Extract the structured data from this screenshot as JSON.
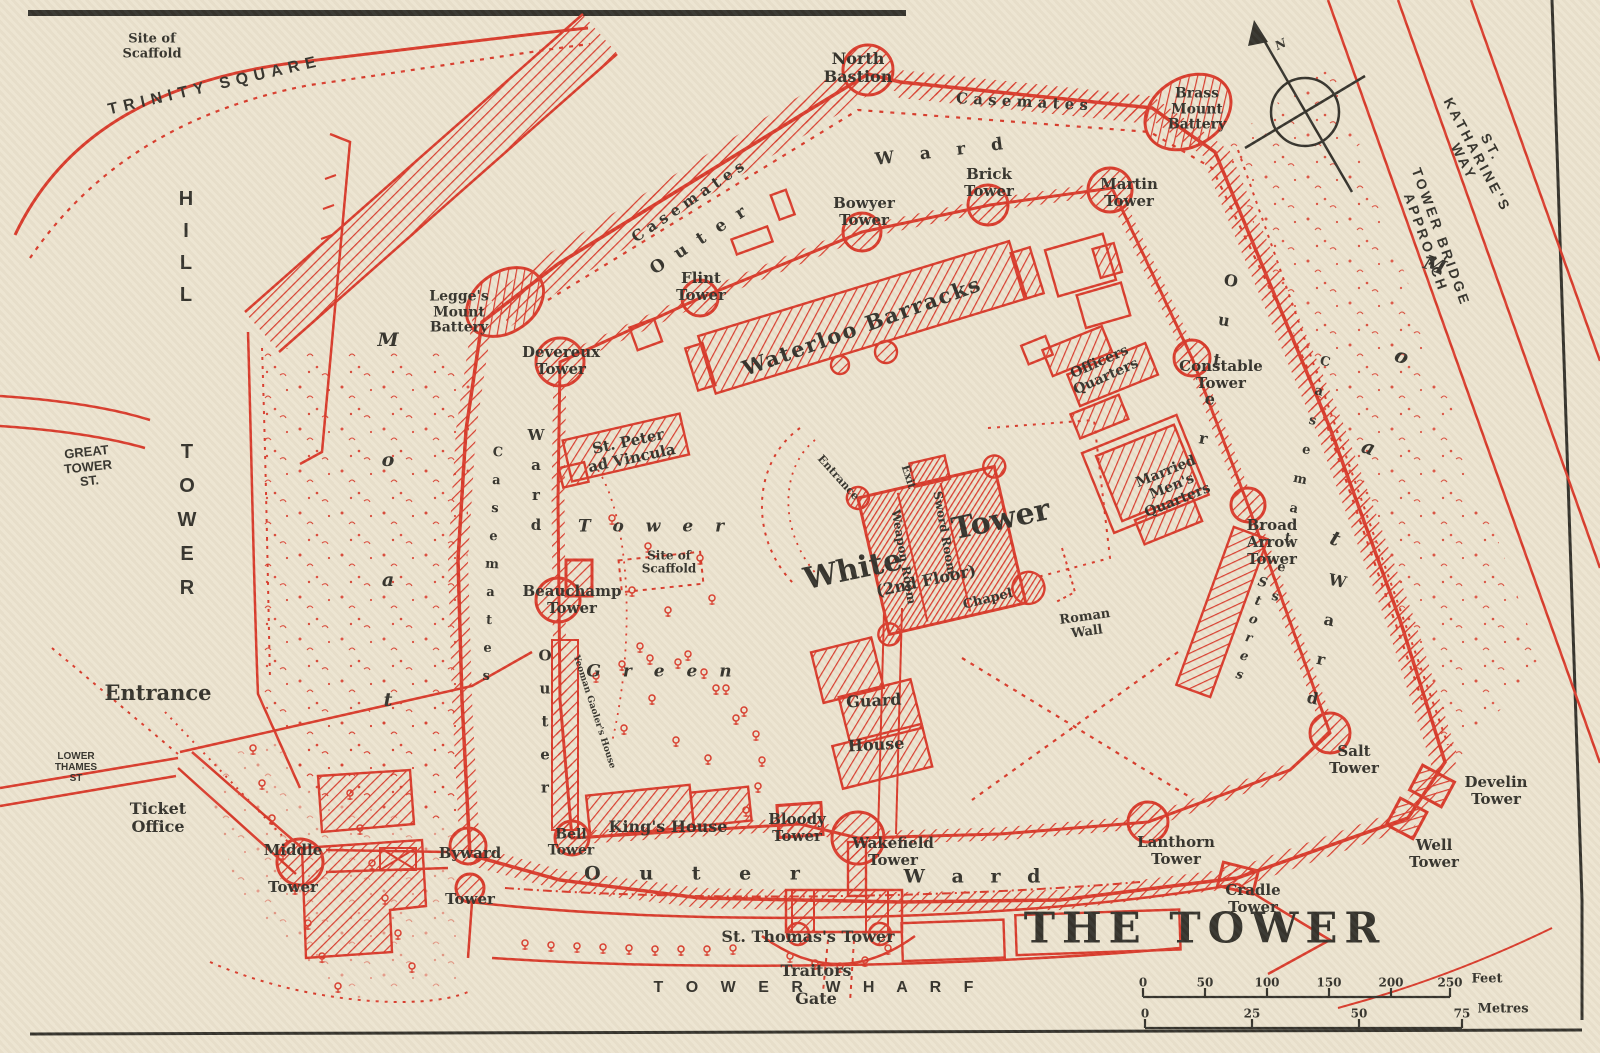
{
  "map": {
    "title": "THE TOWER",
    "subject": "Tower of London vintage plan",
    "colors": {
      "paper": "#ece4d0",
      "ink_red": "#d93a2b",
      "ink_black": "#33312b"
    },
    "compass": {
      "north_label": "N"
    }
  },
  "scale": {
    "feet": {
      "ticks": [
        "0",
        "50",
        "100",
        "150",
        "200",
        "250"
      ],
      "unit": "Feet"
    },
    "metres": {
      "ticks": [
        "0",
        "25",
        "50",
        "75"
      ],
      "unit": "Metres"
    }
  },
  "labels": [
    {
      "n": "site-of-scaffold-trinity",
      "t": "Site of\nScaffold",
      "x": 152,
      "y": 47,
      "s": 13
    },
    {
      "n": "trinity-square-street",
      "t": "TRINITY SQUARE",
      "x": 215,
      "y": 86,
      "s": 16,
      "r": -13,
      "c": "sans",
      "ls": 6
    },
    {
      "n": "tower-hill-street-word1",
      "t": "T\nO\nW\nE\nR",
      "x": 187,
      "y": 520,
      "s": 20,
      "c": "sans",
      "lh": 34
    },
    {
      "n": "tower-hill-street-word2",
      "t": "H\nI\nL\nL",
      "x": 186,
      "y": 247,
      "s": 20,
      "c": "sans",
      "lh": 32
    },
    {
      "n": "great-tower-st-street",
      "t": "GREAT\nTOWER\nST.",
      "x": 88,
      "y": 467,
      "s": 13,
      "r": -6,
      "c": "sans"
    },
    {
      "n": "entrance-label",
      "t": "Entrance",
      "x": 158,
      "y": 693,
      "s": 21
    },
    {
      "n": "lower-thames-st-street",
      "t": "LOWER\nTHAMES\nST",
      "x": 76,
      "y": 768,
      "s": 10,
      "c": "sans"
    },
    {
      "n": "ticket-office-label",
      "t": "Ticket\nOffice",
      "x": 158,
      "y": 818,
      "s": 16
    },
    {
      "n": "st-katharines-way-street",
      "t": "ST. KATHARINE'S WAY",
      "x": 1477,
      "y": 155,
      "s": 14,
      "r": 62,
      "c": "sans",
      "ls": 3
    },
    {
      "n": "tower-bridge-approach-street",
      "t": "TOWER BRIDGE APPROACH",
      "x": 1433,
      "y": 240,
      "s": 14,
      "r": 70,
      "c": "sans",
      "ls": 3
    },
    {
      "n": "moat-left-label",
      "t": "M\no\na\nt",
      "x": 388,
      "y": 520,
      "s": 19,
      "c": "it",
      "lh": 120
    },
    {
      "n": "moat-right-label",
      "t": "M\no\na\nt",
      "x": 1385,
      "y": 402,
      "s": 20,
      "r": 20,
      "c": "it",
      "lh": 97
    },
    {
      "n": "tower-wharf-street",
      "t": "T O W E R    W H A R F",
      "x": 818,
      "y": 988,
      "s": 16,
      "c": "sans",
      "ls": 9
    },
    {
      "n": "map-title",
      "t": "THE TOWER",
      "x": 1205,
      "y": 928,
      "s": 42,
      "c": "title"
    },
    {
      "n": "north-bastion-label",
      "t": "North\nBastion",
      "x": 858,
      "y": 68,
      "s": 16
    },
    {
      "n": "casemates-top-label",
      "t": "C a s e m a t e s",
      "x": 1022,
      "y": 102,
      "s": 15,
      "r": 3
    },
    {
      "n": "casemates-nw-label",
      "t": "C a s e m a t e s",
      "x": 688,
      "y": 202,
      "s": 15,
      "r": -34
    },
    {
      "n": "outer-ward-top-outer",
      "t": "O u t e r",
      "x": 700,
      "y": 240,
      "s": 17,
      "r": -33,
      "ls": 4
    },
    {
      "n": "outer-ward-top-ward",
      "t": "W a r d",
      "x": 944,
      "y": 152,
      "s": 17,
      "r": -7,
      "ls": 10
    },
    {
      "n": "brass-mount-battery-label",
      "t": "Brass\nMount\nBattery",
      "x": 1197,
      "y": 110,
      "s": 14
    },
    {
      "n": "bowyer-tower-label",
      "t": "Bowyer\nTower",
      "x": 864,
      "y": 212,
      "s": 15
    },
    {
      "n": "brick-tower-label",
      "t": "Brick\nTower",
      "x": 989,
      "y": 183,
      "s": 15
    },
    {
      "n": "martin-tower-label",
      "t": "Martin\nTower",
      "x": 1129,
      "y": 193,
      "s": 15
    },
    {
      "n": "flint-tower-label",
      "t": "Flint\nTower",
      "x": 701,
      "y": 287,
      "s": 15
    },
    {
      "n": "legges-mount-battery-label",
      "t": "Legge's\nMount\nBattery",
      "x": 459,
      "y": 313,
      "s": 14
    },
    {
      "n": "devereux-tower-label",
      "t": "Devereux\nTower",
      "x": 561,
      "y": 361,
      "s": 15
    },
    {
      "n": "waterloo-barracks-label",
      "t": "Waterloo  Barracks",
      "x": 862,
      "y": 326,
      "s": 21,
      "r": -20,
      "ls": 2
    },
    {
      "n": "st-peter-ad-vincula-label",
      "t": "St. Peter\nad Vincula",
      "x": 630,
      "y": 450,
      "s": 15,
      "r": -12
    },
    {
      "n": "officers-quarters-label",
      "t": "Officers\nQuarters",
      "x": 1103,
      "y": 370,
      "s": 14,
      "r": -24
    },
    {
      "n": "constable-tower-label",
      "t": "Constable\nTower",
      "x": 1221,
      "y": 375,
      "s": 15
    },
    {
      "n": "married-mens-quarters-label",
      "t": "Married\nMen's\nQuarters",
      "x": 1172,
      "y": 487,
      "s": 14,
      "r": -22
    },
    {
      "n": "broad-arrow-tower-label",
      "t": "Broad\nArrow\nTower",
      "x": 1272,
      "y": 542,
      "s": 15
    },
    {
      "n": "tower-green-tower",
      "t": "T o w e r",
      "x": 655,
      "y": 527,
      "s": 17,
      "c": "it",
      "ls": 8
    },
    {
      "n": "tower-green-green",
      "t": "G r e e n",
      "x": 663,
      "y": 672,
      "s": 17,
      "c": "it",
      "ls": 8
    },
    {
      "n": "site-of-scaffold-green",
      "t": "Site of\nScaffold",
      "x": 669,
      "y": 563,
      "s": 12
    },
    {
      "n": "beauchamp-tower-label",
      "t": "Beauchamp\nTower",
      "x": 572,
      "y": 600,
      "s": 15
    },
    {
      "n": "white-tower-white",
      "t": "White",
      "x": 853,
      "y": 570,
      "s": 30,
      "r": -12
    },
    {
      "n": "white-tower-tower",
      "t": "Tower",
      "x": 1001,
      "y": 520,
      "s": 30,
      "r": -12
    },
    {
      "n": "white-tower-floor",
      "t": "(2nd Floor)",
      "x": 926,
      "y": 581,
      "s": 16,
      "r": -12
    },
    {
      "n": "weapon-room-label",
      "t": "Weapon Room",
      "x": 903,
      "y": 557,
      "s": 12,
      "r": 80
    },
    {
      "n": "sword-room-label",
      "t": "Sword Room",
      "x": 944,
      "y": 533,
      "s": 12,
      "r": 80
    },
    {
      "n": "chapel-label",
      "t": "Chapel",
      "x": 988,
      "y": 600,
      "s": 13,
      "r": -14
    },
    {
      "n": "white-tower-entrance",
      "t": "Entrance",
      "x": 838,
      "y": 478,
      "s": 11,
      "r": 48
    },
    {
      "n": "white-tower-exit",
      "t": "Exit",
      "x": 908,
      "y": 477,
      "s": 11,
      "r": 72
    },
    {
      "n": "roman-wall-label",
      "t": "Roman\nWall",
      "x": 1086,
      "y": 625,
      "s": 13,
      "r": -8
    },
    {
      "n": "guard-house-label",
      "t": "Guard\nHouse",
      "x": 875,
      "y": 723,
      "s": 16,
      "r": -3,
      "lh": 44
    },
    {
      "n": "stores-label",
      "t": "S\nt\no\nr\ne\ns",
      "x": 1251,
      "y": 629,
      "s": 13,
      "r": 14,
      "c": "it",
      "lh": 19
    },
    {
      "n": "outer-ward-right-outer",
      "t": "O\nu\nt\ne\nr",
      "x": 1217,
      "y": 360,
      "s": 16,
      "r": 10,
      "lh": 40
    },
    {
      "n": "outer-ward-right-ward",
      "t": "W\na\nr\nd",
      "x": 1325,
      "y": 640,
      "s": 16,
      "r": 12,
      "lh": 40
    },
    {
      "n": "casemates-right-label",
      "t": "C\na\ns\ne\nm\na\nt\ne\ns",
      "x": 1300,
      "y": 480,
      "s": 13,
      "r": 12,
      "lh": 30
    },
    {
      "n": "casemates-left-label",
      "t": "C\na\ns\ne\nm\na\nt\ne\ns",
      "x": 492,
      "y": 565,
      "s": 13,
      "r": 3,
      "lh": 28
    },
    {
      "n": "outer-ward-left-ward",
      "t": "W\na\nr\nd",
      "x": 536,
      "y": 480,
      "s": 15,
      "lh": 30
    },
    {
      "n": "outer-ward-left-outer",
      "t": "O\nu\nt\ne\nr",
      "x": 545,
      "y": 722,
      "s": 15,
      "lh": 33
    },
    {
      "n": "outer-ward-bottom-outer",
      "t": "O u t e r",
      "x": 700,
      "y": 874,
      "s": 19,
      "ls": 16
    },
    {
      "n": "outer-ward-bottom-ward",
      "t": "W a r d",
      "x": 977,
      "y": 877,
      "s": 19,
      "ls": 10
    },
    {
      "n": "bell-tower-label",
      "t": "Bell\nTower",
      "x": 571,
      "y": 843,
      "s": 14
    },
    {
      "n": "kings-house-label",
      "t": "King's House",
      "x": 668,
      "y": 827,
      "s": 16
    },
    {
      "n": "bloody-tower-label",
      "t": "Bloody\nTower",
      "x": 797,
      "y": 828,
      "s": 15
    },
    {
      "n": "wakefield-tower-label",
      "t": "Wakefield\nTower",
      "x": 893,
      "y": 852,
      "s": 15
    },
    {
      "n": "byward-tower-label",
      "t": "Byward\nTower",
      "x": 470,
      "y": 876,
      "s": 15,
      "lh": 46
    },
    {
      "n": "middle-tower-label",
      "t": "Middle\nTower",
      "x": 293,
      "y": 869,
      "s": 15,
      "lh": 37
    },
    {
      "n": "lanthorn-tower-label",
      "t": "Lanthorn\nTower",
      "x": 1176,
      "y": 851,
      "s": 15
    },
    {
      "n": "cradle-tower-label",
      "t": "Cradle\nTower",
      "x": 1253,
      "y": 899,
      "s": 15
    },
    {
      "n": "salt-tower-label",
      "t": "Salt\nTower",
      "x": 1354,
      "y": 760,
      "s": 15
    },
    {
      "n": "well-tower-label",
      "t": "Well\nTower",
      "x": 1434,
      "y": 854,
      "s": 15
    },
    {
      "n": "develin-tower-label",
      "t": "Develin\nTower",
      "x": 1496,
      "y": 791,
      "s": 15
    },
    {
      "n": "st-thomass-tower-label",
      "t": "St. Thomas's Tower",
      "x": 808,
      "y": 937,
      "s": 16
    },
    {
      "n": "traitors-gate-label",
      "t": "Traitors\nGate",
      "x": 816,
      "y": 985,
      "s": 16,
      "lh": 28
    },
    {
      "n": "yeoman-gaolers-house-label",
      "t": "Yeoman Gaoler's House",
      "x": 594,
      "y": 712,
      "s": 9,
      "r": 72
    },
    {
      "n": "compass-north-label",
      "t": "N",
      "x": 1281,
      "y": 45,
      "s": 12,
      "r": -25,
      "c": "it"
    }
  ]
}
